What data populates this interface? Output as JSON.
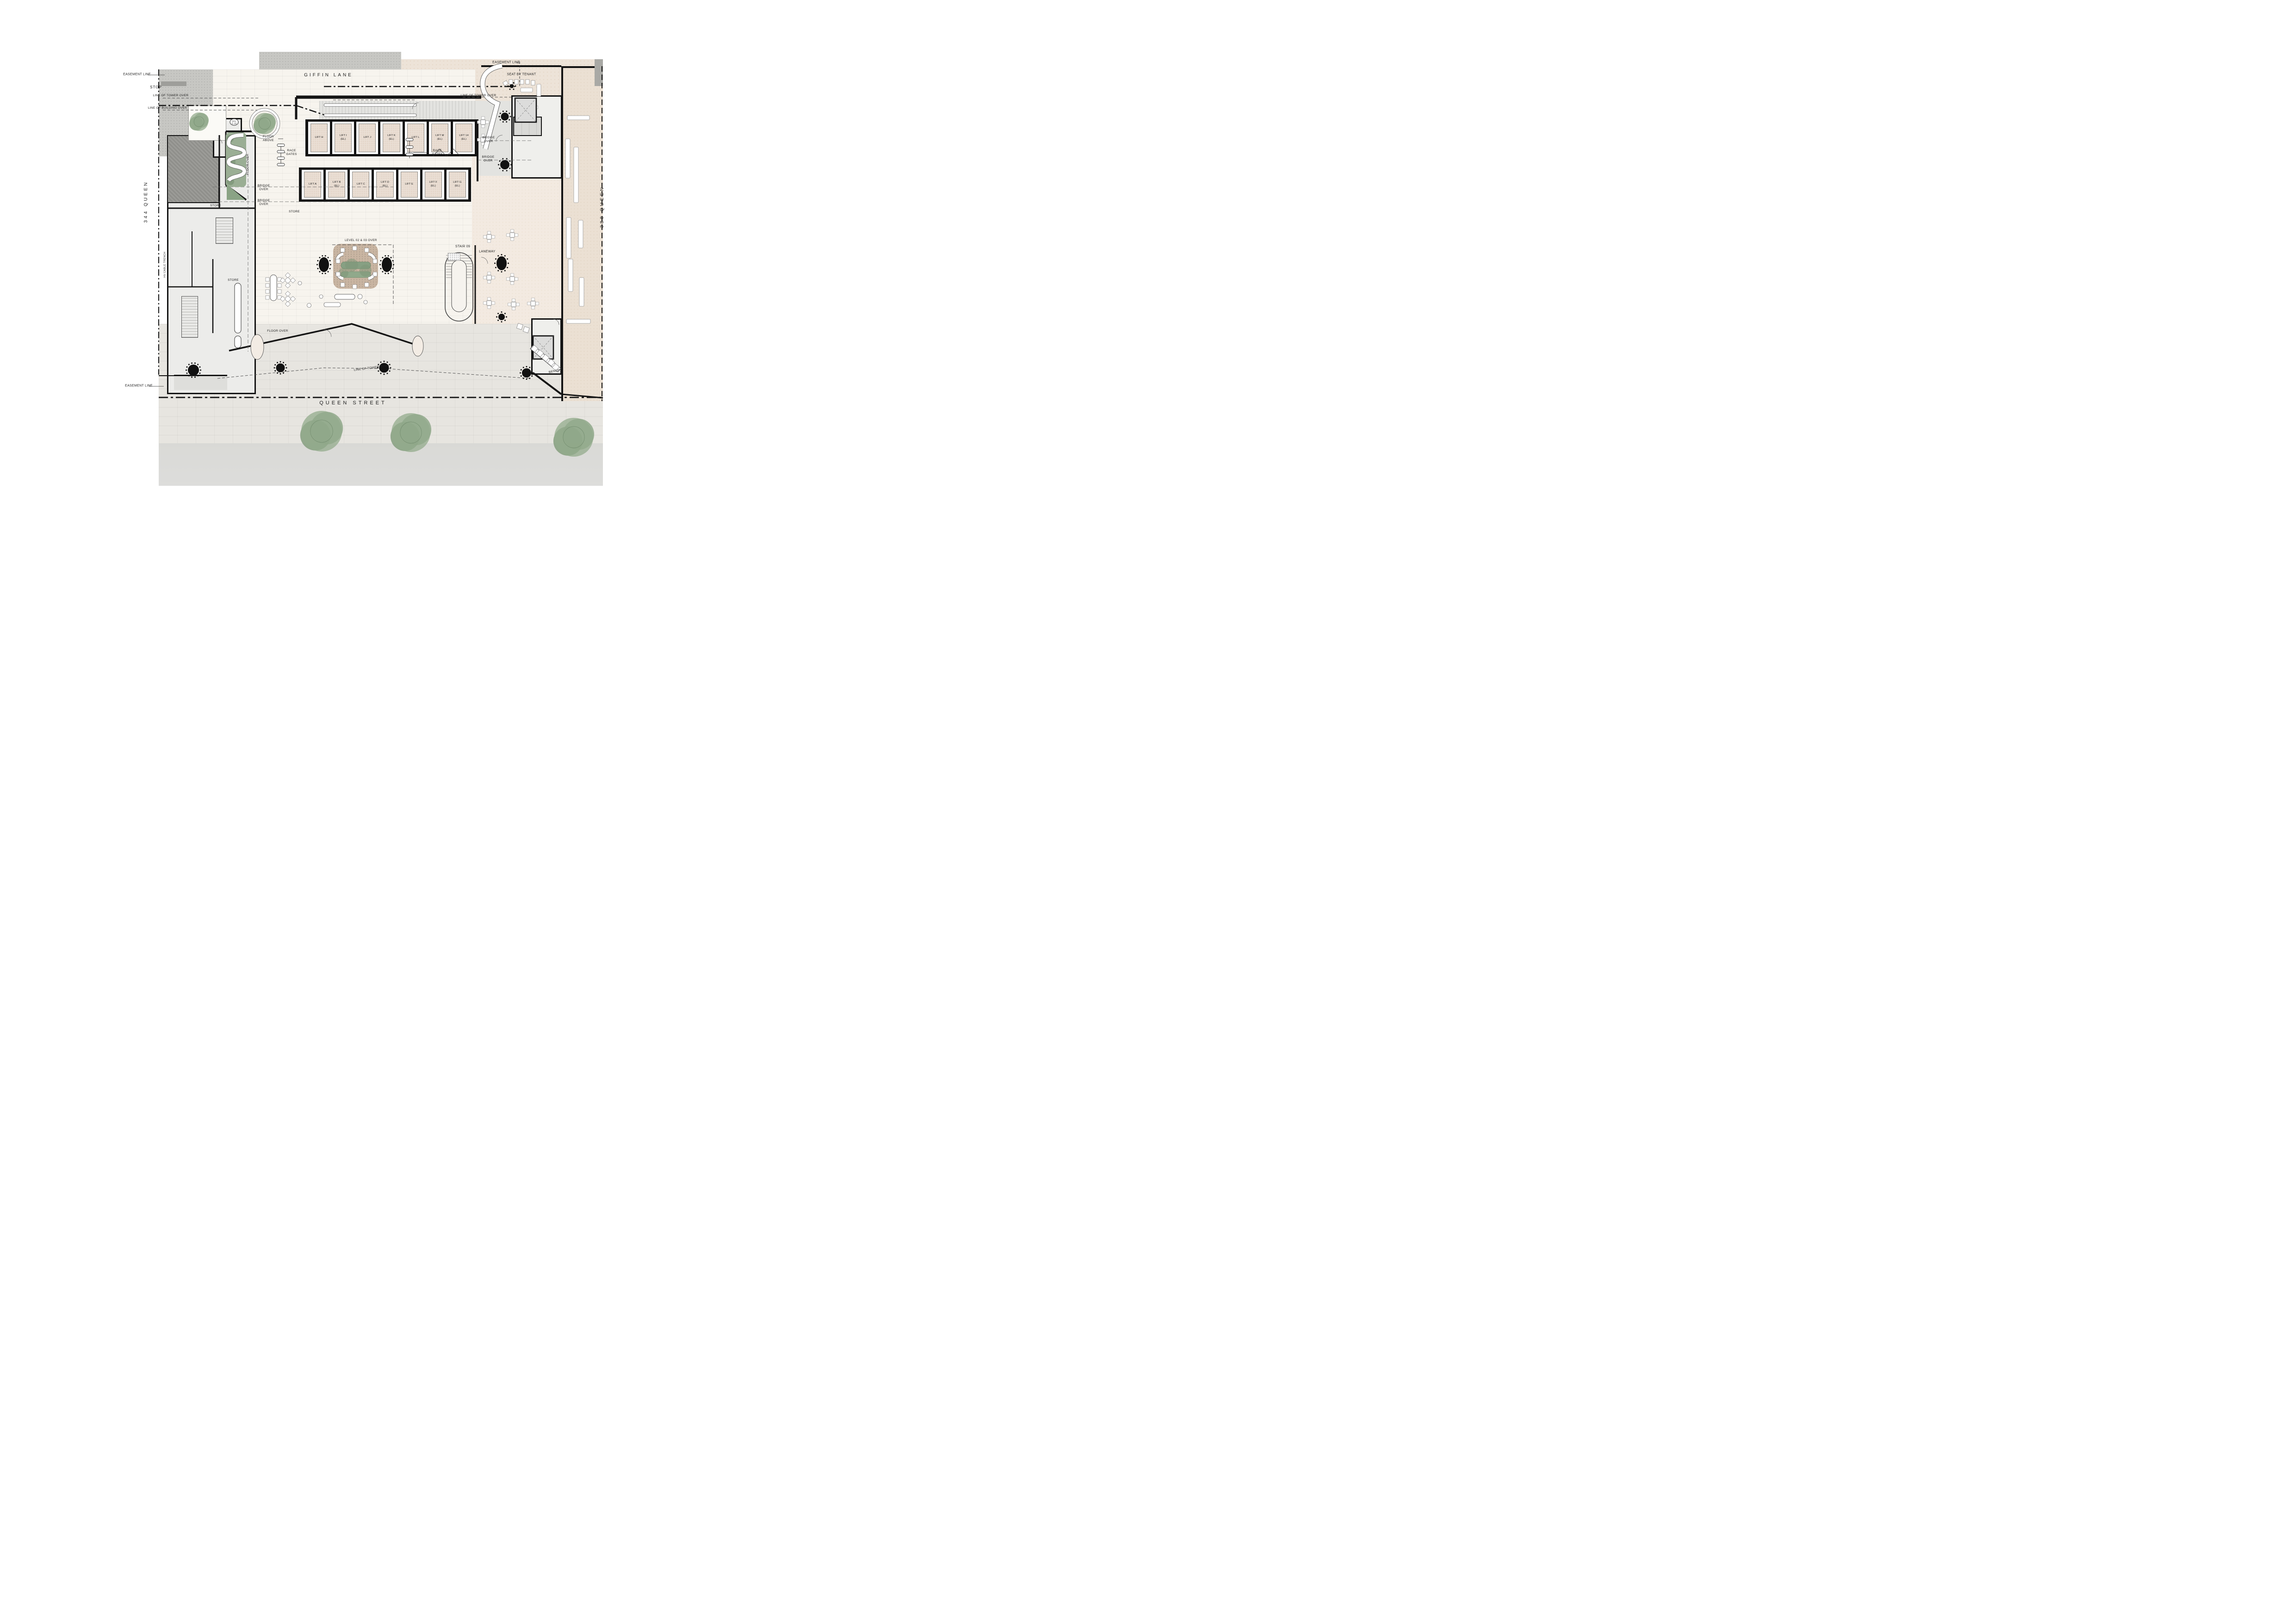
{
  "drawing": {
    "type": "architectural-floor-plan",
    "streets": {
      "top": "GIFFIN LANE",
      "bottom": "QUEEN STREET",
      "left": "344 QUEEN",
      "right": "388 QUEEN"
    },
    "annotations": [
      {
        "id": "giffin-lane",
        "text": "GIFFIN LANE"
      },
      {
        "id": "queen-street",
        "text": "QUEEN STREET"
      },
      {
        "id": "queen-344",
        "text": "344 QUEEN"
      },
      {
        "id": "queen-388",
        "text": "388 QUEEN"
      },
      {
        "id": "easement-top-left",
        "text": "EASEMENT LINE"
      },
      {
        "id": "easement-top-right",
        "text": "EASEMENT LINE"
      },
      {
        "id": "easement-bottom-left",
        "text": "EASEMENT LINE"
      },
      {
        "id": "stop",
        "text": "STOP"
      },
      {
        "id": "line-tower-top-left",
        "text": "LINE OF TOWER OVER"
      },
      {
        "id": "line-building-top-left",
        "text": "LINE OF BUILDING OVER"
      },
      {
        "id": "line-tower-top-center",
        "text": "LINE OF TOWER OVER"
      },
      {
        "id": "line-tower-top-right",
        "text": "LINE OF TOWER OVER"
      },
      {
        "id": "line-tower-bottom",
        "text": "LINE OF TOWER OVER"
      },
      {
        "id": "seat-by-tenant",
        "text": "SEAT BY TENANT"
      },
      {
        "id": "floor-above",
        "text": "FLOOR\nABOVE"
      },
      {
        "id": "race-gates-left",
        "text": "RACE\nGATES"
      },
      {
        "id": "race-gates-right",
        "text": "RACE\nGATES"
      },
      {
        "id": "floor-over-west",
        "text": "FLOOR OVER"
      },
      {
        "id": "bridge-over-west-1",
        "text": "BRIDGE\nOVER"
      },
      {
        "id": "bridge-over-west-2",
        "text": "BRIDGE\nOVER"
      },
      {
        "id": "bridge-over-east-1",
        "text": "BRIDGE\nOVER"
      },
      {
        "id": "bridge-over-east-2",
        "text": "BRIDGE\nOVER"
      },
      {
        "id": "level-02-03",
        "text": "LEVEL 02 & 03 OVER"
      },
      {
        "id": "stair-09",
        "text": "STAIR 09"
      },
      {
        "id": "laneway",
        "text": "LANEWAY"
      },
      {
        "id": "store-west",
        "text": "STORE"
      },
      {
        "id": "store-south",
        "text": "STORE"
      },
      {
        "id": "store-core",
        "text": "STORE"
      },
      {
        "id": "hv-cable-trench",
        "text": "HV CABLE TRENCH"
      },
      {
        "id": "floor-over-entry",
        "text": "FLOOR OVER"
      },
      {
        "id": "bench",
        "text": "BENCH"
      },
      {
        "id": "door-tag",
        "text": "D01\nG.26"
      }
    ],
    "lifts": {
      "top_row": [
        "LIFT H",
        "LIFT I\n(EL)",
        "LIFT J",
        "LIFT K\n(EL)",
        "LIFT L",
        "LIFT M\n(EL)",
        "LIFT 14\n(EL)"
      ],
      "bottom_row": [
        "LIFT A",
        "LIFT B\n(EL)",
        "LIFT C",
        "LIFT D\n(EL)",
        "LIFT E",
        "LIFT F\n(EL)",
        "LIFT G\n(EL)"
      ]
    },
    "colors": {
      "paving_gray": "#c7c7c3",
      "paving_beige": "#ede3d8",
      "lobby_floor": "#f7f4ee",
      "planter_brown": "#c9b5a2",
      "planting_green": "#87a083",
      "wall_black": "#141414"
    }
  }
}
